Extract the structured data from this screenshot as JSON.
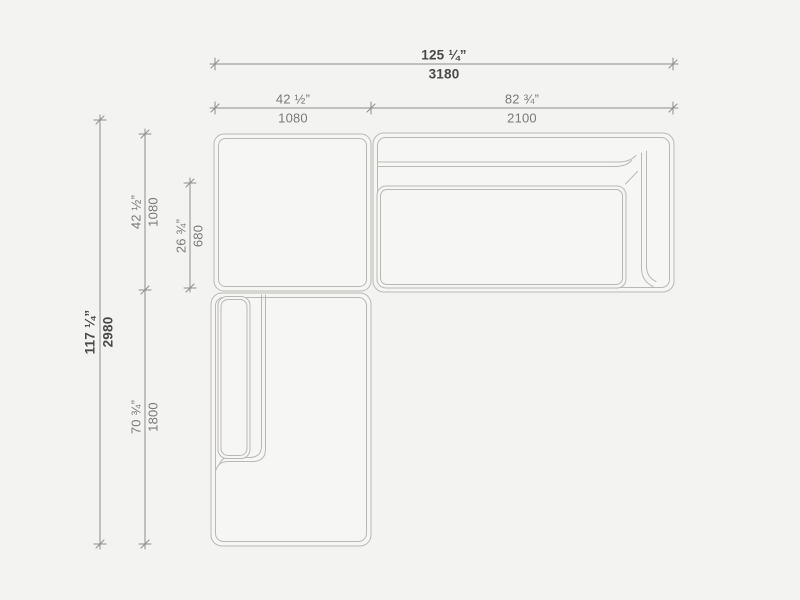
{
  "title": "Sectional sofa top-view dimension drawing",
  "colors": {
    "background": "#f3f3f1",
    "module_fill": "#f6f6f4",
    "furniture_stroke": "#b9b8b5",
    "dim_stroke": "#8f8e8b",
    "label_primary": "#4a4947",
    "label_secondary": "#7a7974"
  },
  "dimensions": {
    "overall_width": {
      "inches": "125 ¼”",
      "mm": "3180"
    },
    "left_module_width": {
      "inches": "42 ½”",
      "mm": "1080"
    },
    "right_module_width": {
      "inches": "82 ¾”",
      "mm": "2100"
    },
    "overall_depth": {
      "inches": "117 ¼”",
      "mm": "2980"
    },
    "top_module_depth": {
      "inches": "42 ½”",
      "mm": "1080"
    },
    "seat_depth": {
      "inches": "26 ¾”",
      "mm": "680"
    },
    "chaise_length": {
      "inches": "70 ¾”",
      "mm": "1800"
    }
  }
}
